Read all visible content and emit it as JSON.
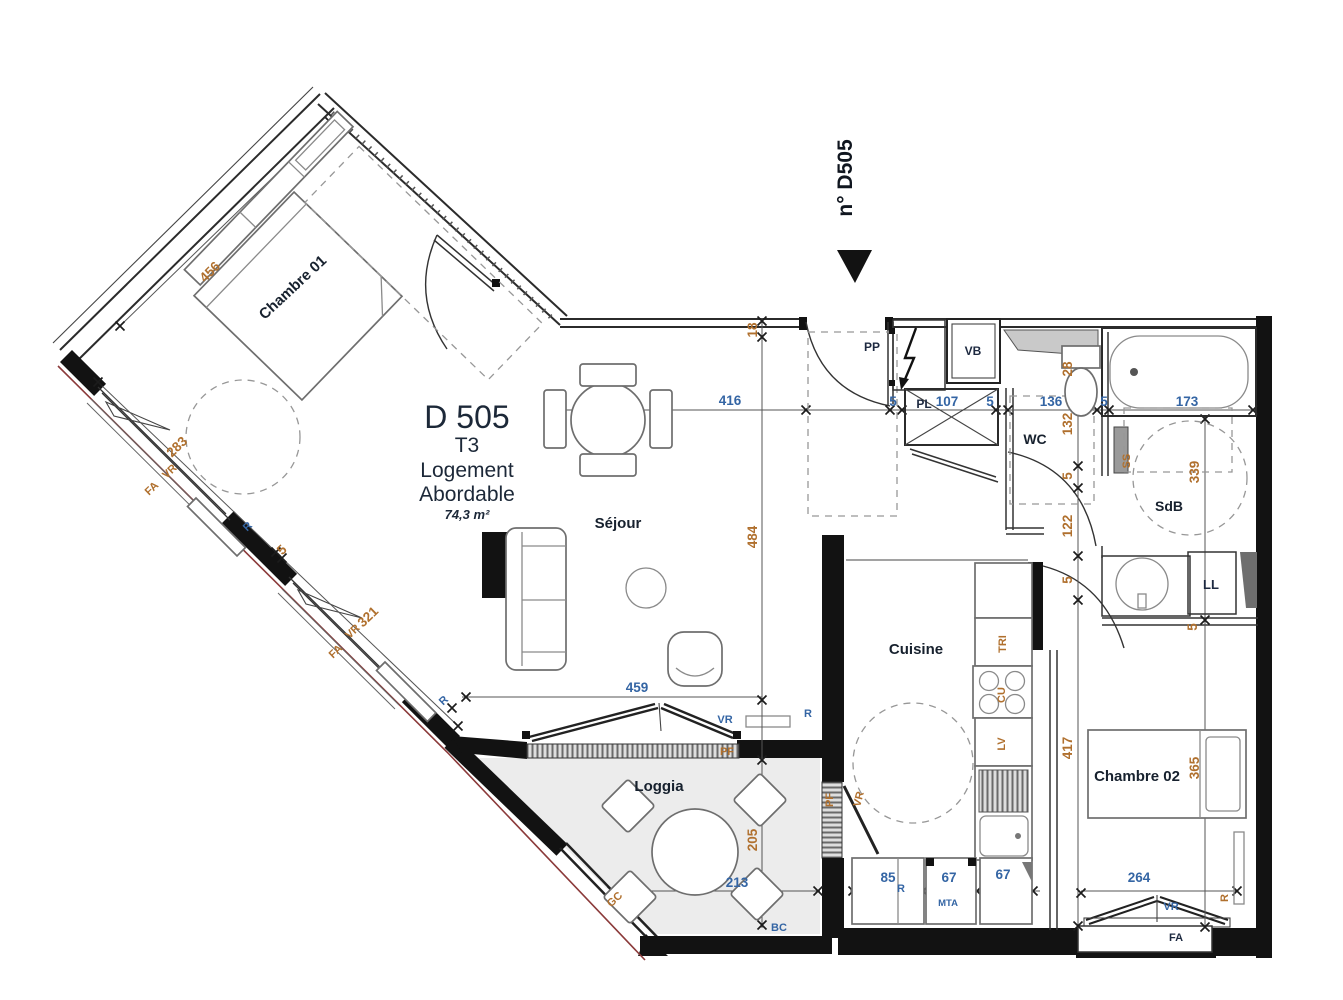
{
  "header": {
    "unit_number": "n° D505"
  },
  "title_block": {
    "lot_code": "D 505",
    "type": "T3",
    "program_line1": "Logement",
    "program_line2": "Abordable",
    "area": "74,3 m²"
  },
  "rooms": {
    "bedroom1": "Chambre 01",
    "living": "Séjour",
    "kitchen": "Cuisine",
    "wc": "WC",
    "bathroom": "SdB",
    "bedroom2": "Chambre 02",
    "loggia": "Loggia"
  },
  "dims": {
    "d456": "456",
    "d283": "283",
    "d321": "321",
    "d459": "459",
    "d416": "416",
    "d484": "484",
    "d18": "18",
    "d5": "5",
    "d107": "107",
    "d136": "136",
    "d173": "173",
    "d28": "28",
    "d132": "132",
    "d122": "122",
    "d339": "339",
    "d205": "205",
    "d213": "213",
    "d417": "417",
    "d365": "365",
    "d264": "264",
    "d85": "85",
    "d67": "67"
  },
  "codes": {
    "vr": "VR",
    "fa": "FA",
    "r": "R",
    "pf": "PF",
    "pp": "PP",
    "vb": "VB",
    "pl": "PL",
    "ss": "SS",
    "ll": "LL",
    "tri": "TRI",
    "cu": "CU",
    "lv": "LV",
    "mta": "MTA",
    "gc": "GC",
    "bc": "BC"
  },
  "colors": {
    "dimension_blue": "#3465a4",
    "dimension_orange": "#b0702e",
    "wall_black": "#121212",
    "loggia_fill": "#ececec"
  }
}
